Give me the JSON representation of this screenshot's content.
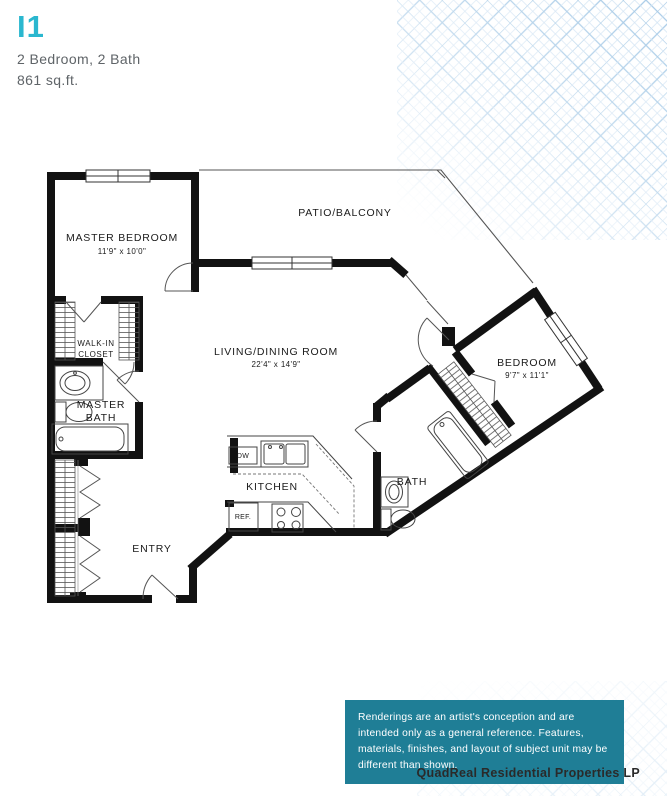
{
  "header": {
    "plan_code": "I1",
    "specs": "2 Bedroom, 2 Bath",
    "area": "861 sq.ft."
  },
  "rooms": {
    "master_bedroom": {
      "name": "MASTER BEDROOM",
      "dims": "11'9\" x 10'0\""
    },
    "patio": {
      "name": "PATIO/BALCONY"
    },
    "living_dining": {
      "name": "LIVING/DINING ROOM",
      "dims": "22'4\" x 14'9\""
    },
    "bedroom": {
      "name": "BEDROOM",
      "dims": "9'7\" x 11'1\""
    },
    "walk_in_closet": {
      "line1": "WALK-IN",
      "line2": "CLOSET"
    },
    "master_bath": {
      "line1": "MASTER",
      "line2": "BATH"
    },
    "kitchen": {
      "name": "KITCHEN"
    },
    "bath": {
      "name": "BATH"
    },
    "entry": {
      "name": "ENTRY"
    }
  },
  "appliances": {
    "dishwasher": "DW",
    "refrigerator": "REF."
  },
  "disclaimer": {
    "text": "Renderings are an artist's conception and are intended only as a general reference. Features, materials, finishes, and layout of subject unit may be different than shown."
  },
  "footer": {
    "company": "QuadReal Residential Properties LP"
  },
  "colors": {
    "accent": "#2ab7cf",
    "disclaimer_bg": "#1f7e96",
    "wall": "#121212",
    "pattern_line": "#a5c9e6"
  }
}
